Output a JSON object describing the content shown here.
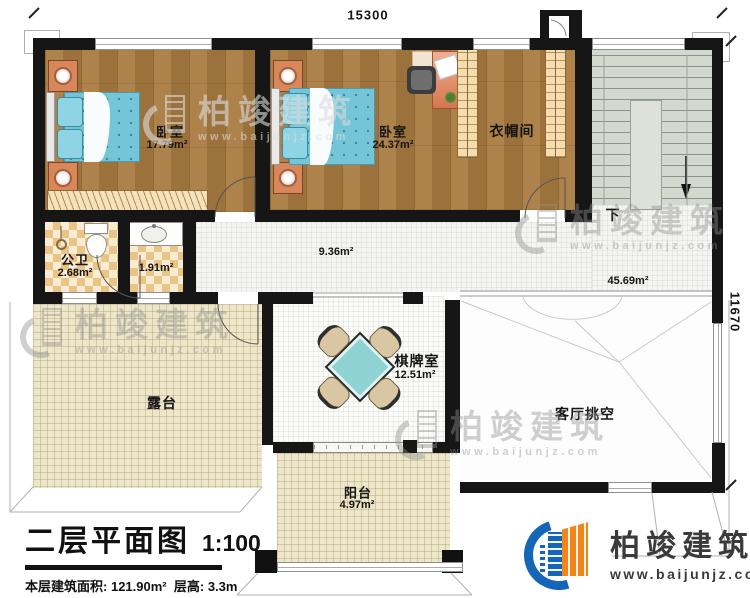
{
  "dimensions": {
    "top": "15300",
    "right": "11670"
  },
  "rooms": {
    "bedroom1": {
      "name": "卧室",
      "area": "17.79m²"
    },
    "bedroom2": {
      "name": "卧室",
      "area": "24.37m²"
    },
    "cloakroom": {
      "name": "衣帽间"
    },
    "bathroom": {
      "name": "公卫",
      "area": "2.68m²"
    },
    "washroom": {
      "area": "1.91m²"
    },
    "hallway": {
      "area": "9.36m²"
    },
    "stair_hall": {
      "area": "45.69m²"
    },
    "stairs": {
      "down_label": "下"
    },
    "chess_room": {
      "name": "棋牌室",
      "area": "12.51m²"
    },
    "terrace": {
      "name": "露台"
    },
    "living_void": {
      "name": "客厅挑空"
    },
    "balcony": {
      "name": "阳台",
      "area": "4.97m²"
    }
  },
  "title_block": {
    "title": "二层平面图",
    "scale": "1:100",
    "info_label": "本层建筑面积:",
    "area_value": "121.90m²",
    "height_label": "层高:",
    "height_value": "3.3m"
  },
  "logo": {
    "name": "柏竣建筑",
    "url": "www.baijunjz.com"
  },
  "watermark": {
    "brand": "柏竣建筑",
    "url": "www.baijunjz.com"
  },
  "colors": {
    "wall": "#161616",
    "wood_floor": "#a87a40",
    "bed": "#74c5d8",
    "tile_beige": "#ede6c8",
    "checker_tan": "#eac387",
    "stair_gray": "#d4d9d0",
    "table_cyan": "#8fd2d4",
    "chair_tan": "#d8c7a2",
    "logo_blue": "#1565b8",
    "logo_orange": "#f08519",
    "watermark_gray": "#8f8f8f"
  }
}
